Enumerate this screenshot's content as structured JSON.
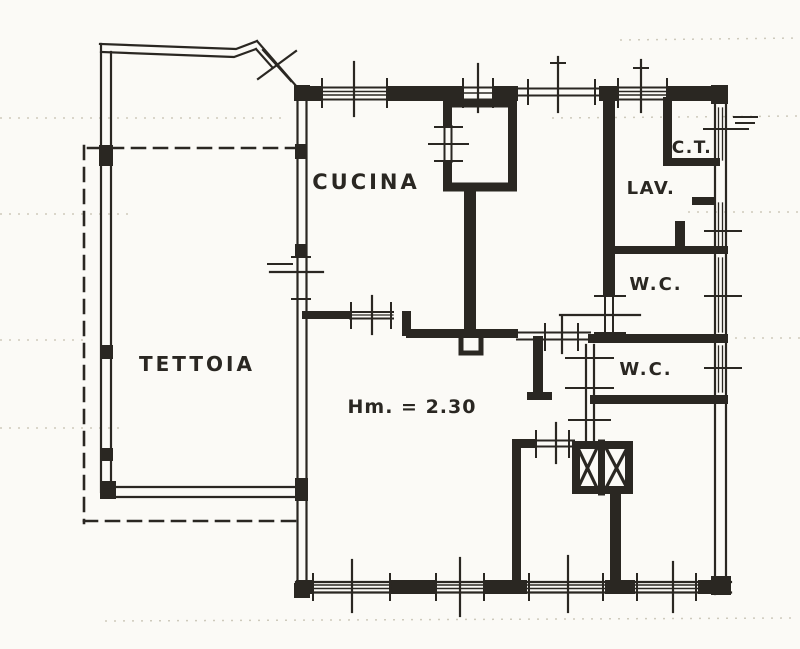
{
  "document": {
    "kind": "scanned floor plan"
  },
  "colors": {
    "ink": "#2a2722",
    "paper": "#fbfaf6",
    "noise": "#c9c4b6"
  },
  "rooms": [
    {
      "id": "tettoia",
      "label": "TETTOIA"
    },
    {
      "id": "cucina",
      "label": "CUCINA"
    },
    {
      "id": "ct",
      "label": "C.T."
    },
    {
      "id": "lav",
      "label": "LAV."
    },
    {
      "id": "wc-upper",
      "label": "W.C."
    },
    {
      "id": "wc-lower",
      "label": "W.C."
    }
  ],
  "annotations": [
    {
      "id": "ceiling-height",
      "text": "Hm. = 2.30"
    }
  ]
}
